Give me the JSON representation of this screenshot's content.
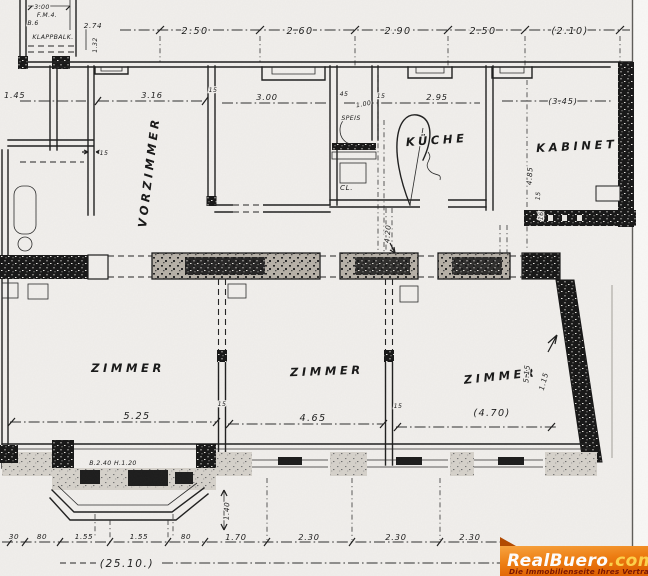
{
  "rooms": {
    "vorzimmer": "VORZIMMER",
    "kitchen": "KÜCHE",
    "kabinet": "KABINET",
    "zimmer1": "ZIMMER",
    "zimmer2": "ZIMMER",
    "zimmer3": "ZIMMER",
    "pantry": "SPEIS",
    "closet": "CL.",
    "balcony": "KLAPPBALK."
  },
  "dims": {
    "top": [
      "2.50",
      "2.60",
      "2.90",
      "2.50",
      "(2.10)"
    ],
    "left_width": "1.45",
    "vorzimmer_width": "3.16",
    "room2_width": "3.00",
    "kitchen_width": "2.95",
    "kabinet_width": "(3.45)",
    "kabinet_height": "4.85",
    "zimmer1_width": "5.25",
    "zimmer2_width": "4.65",
    "zimmer3_width": "(4.70)",
    "zimmer3_v1": "5.15",
    "zimmer3_v2": "1.15",
    "mid_v": "4.20",
    "bay_v": "1.40",
    "bottom": [
      "30",
      "80",
      "1.55",
      "1.55",
      "80",
      "1.70",
      "2.30",
      "2.30",
      "2.30"
    ],
    "total_width": "(25.10.)",
    "wall_ticks": [
      "15",
      "15",
      "15",
      "15",
      "15",
      "15",
      "16"
    ],
    "balcony_width": "3.00",
    "balcony_l1": "F.M.4.",
    "balcony_l2": "B.6",
    "balcony_r": "2.74",
    "balcony_v": "1.32",
    "pantry_n1": "45",
    "pantry_n2": "1.00",
    "window_note": "B.2.40 H.1.20"
  },
  "watermark": {
    "brand": "RealBuero",
    "tld": ".com",
    "tagline": "Die Immobilienseite Ihres Vertrauens"
  }
}
